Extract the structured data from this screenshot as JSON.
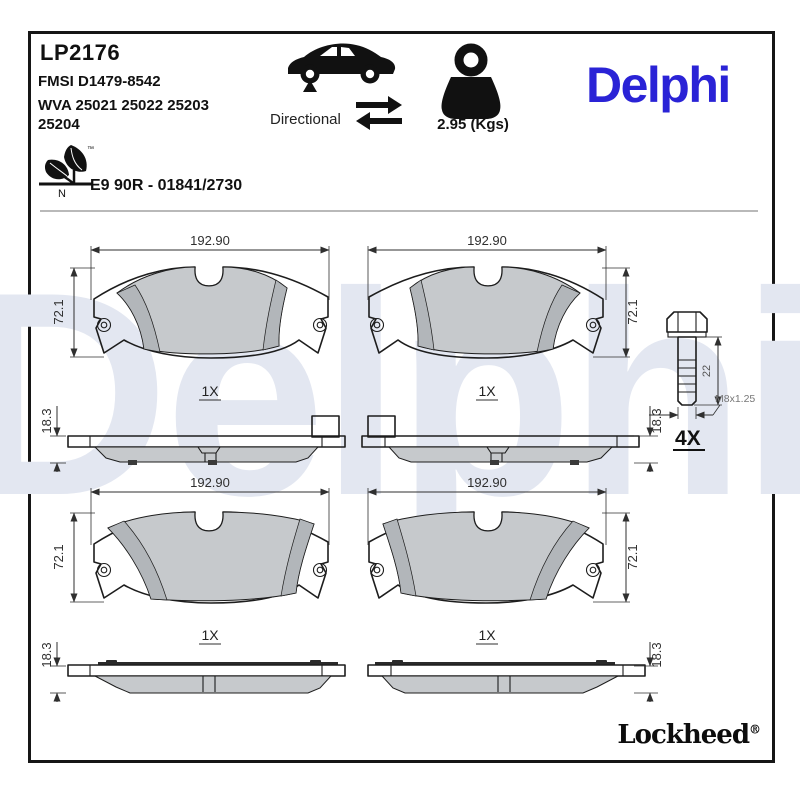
{
  "header": {
    "part_number": "LP2176",
    "fmsi": "FMSI D1479-8542",
    "wva_line1": "WVA 25021 25022 25203",
    "wva_line2": "25204",
    "directional_label": "Directional",
    "weight_label": "2.95 (Kgs)",
    "brand": "Delphi",
    "eco": {
      "tm": "™",
      "letter": "N"
    },
    "homologation": "E9 90R - 01841/2730"
  },
  "icons": {
    "car": "car-side-silhouette",
    "front_axle_marker": "triangle-up",
    "directional_arrows": "left-right-swap-arrows",
    "weight": "kettlebell-weight",
    "eco": "leaf-eco-mark"
  },
  "drawings": {
    "pads": [
      {
        "id": "top-left",
        "width": "192.90",
        "height": "72.1",
        "thickness": "18.3",
        "qty": "1X"
      },
      {
        "id": "top-right",
        "width": "192.90",
        "height": "72.1",
        "thickness": "18.3",
        "qty": "1X"
      },
      {
        "id": "bottom-left",
        "width": "192.90",
        "height": "72.1",
        "thickness": "18.3",
        "qty": "1X"
      },
      {
        "id": "bottom-right",
        "width": "192.90",
        "height": "72.1",
        "thickness": "18.3",
        "qty": "1X"
      }
    ],
    "bolt": {
      "length": "22",
      "thread": "M8x1.25",
      "qty": "4X"
    }
  },
  "footer": {
    "brand": "Lockheed",
    "registered": "®"
  },
  "watermark": {
    "text": "Delphi"
  },
  "colors": {
    "brand_blue": "#2a23d6",
    "watermark_blue": "#e3e7f1",
    "friction_gray": "#c6c9cc",
    "chamfer_gray": "#b2b6ba",
    "line_dark": "#1d1d1d"
  }
}
